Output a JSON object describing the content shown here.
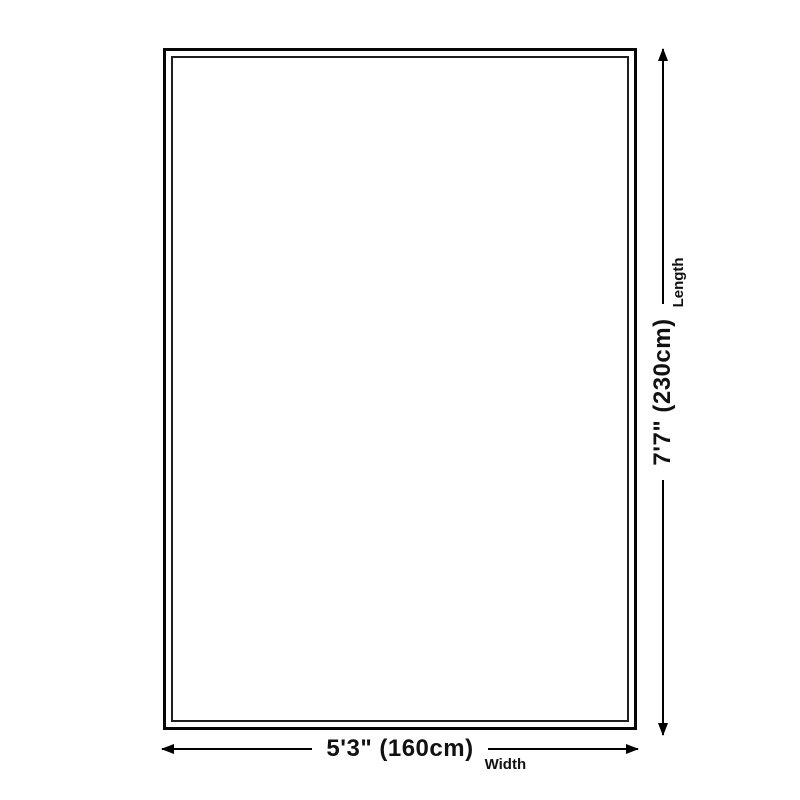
{
  "diagram": {
    "type": "rug-size-diagram",
    "width": {
      "value": "5'3\" (160cm)",
      "label": "Width"
    },
    "length": {
      "value": "7'7\" (230cm)",
      "label": "Length"
    },
    "colors": {
      "background": "#ffffff",
      "outline_outer": "#060606",
      "outline_inner": "#1f1f1f",
      "dimension_line": "#000000",
      "text": "#111111"
    }
  }
}
